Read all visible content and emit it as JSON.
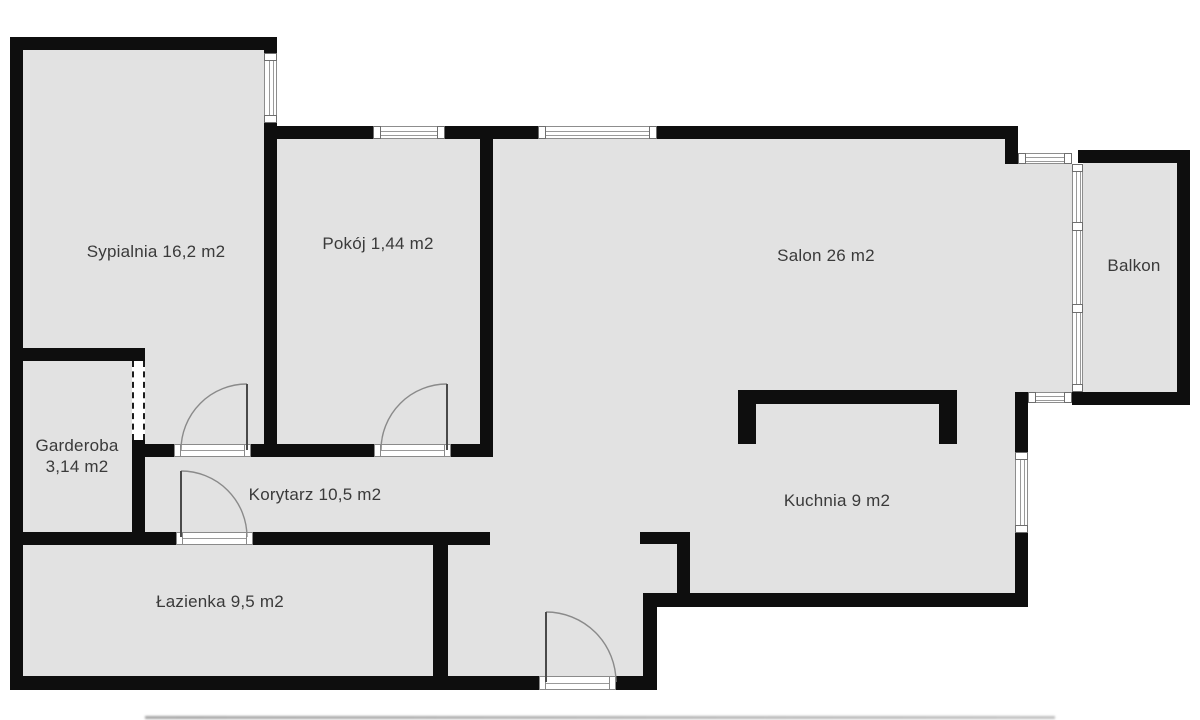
{
  "rooms": [
    {
      "name": "sypialnia",
      "label": "Sypialnia 16,2 m2"
    },
    {
      "name": "pokoj",
      "label": "Pokój 1,44 m2"
    },
    {
      "name": "salon",
      "label": "Salon 26 m2"
    },
    {
      "name": "kuchnia",
      "label": "Kuchnia 9 m2"
    },
    {
      "name": "korytarz",
      "label": "Korytarz 10,5 m2"
    },
    {
      "name": "lazienka",
      "label": "Łazienka 9,5 m2"
    },
    {
      "name": "garderoba",
      "label_line1": "Garderoba",
      "label_line2": "3,14 m2"
    },
    {
      "name": "balkon",
      "label": "Balkon"
    }
  ],
  "colors": {
    "wall": "#0e0e0e",
    "floor": "#e2e2e2",
    "background": "#ffffff",
    "text": "#3a3a3a"
  }
}
